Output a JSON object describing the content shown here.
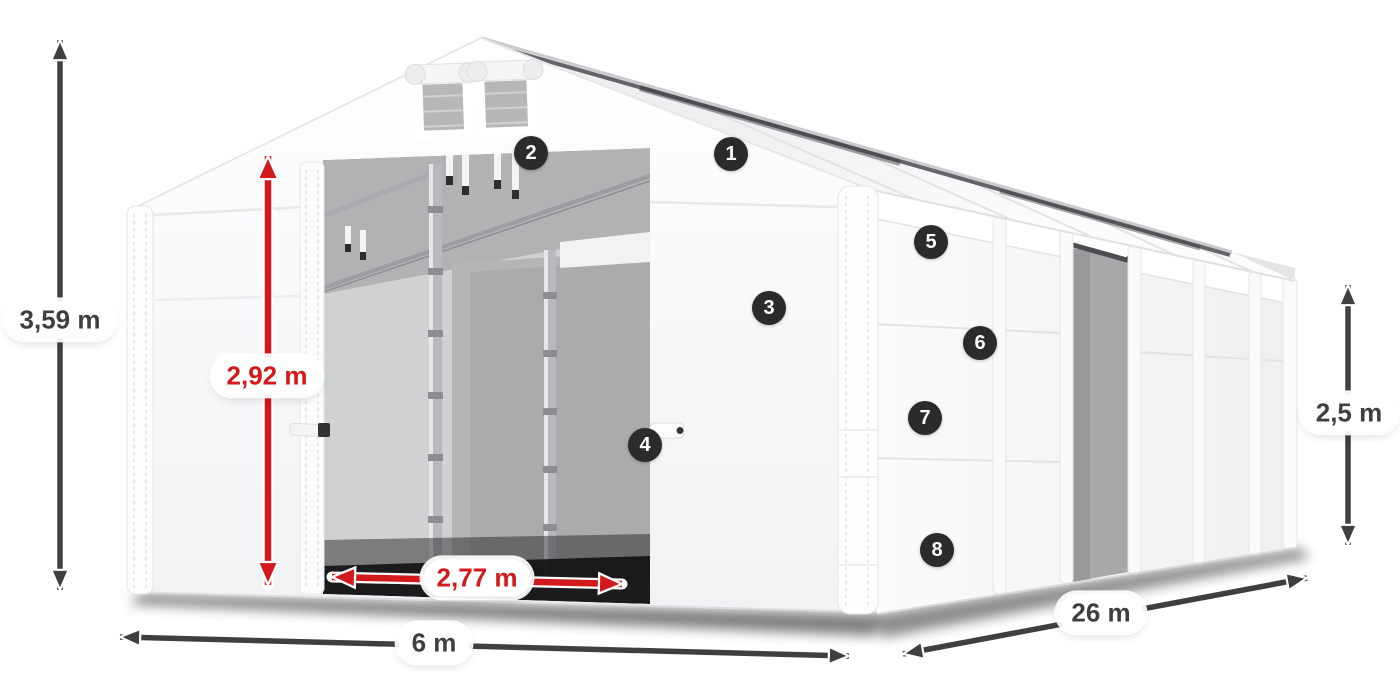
{
  "labels": {
    "total_height": "3,59 m",
    "entrance_height": "2,92 m",
    "entrance_width": "2,77 m",
    "width": "6 m",
    "length": "26 m",
    "side_height": "2,5 m"
  },
  "callouts": [
    {
      "number": "1"
    },
    {
      "number": "2"
    },
    {
      "number": "3"
    },
    {
      "number": "4"
    },
    {
      "number": "5"
    },
    {
      "number": "6"
    },
    {
      "number": "7"
    },
    {
      "number": "8"
    }
  ],
  "colors": {
    "dimension_dark": "#3f3f41",
    "dimension_red": "#d2191b",
    "badge_background": "#2b2b2d",
    "label_background": "#ffffff"
  }
}
